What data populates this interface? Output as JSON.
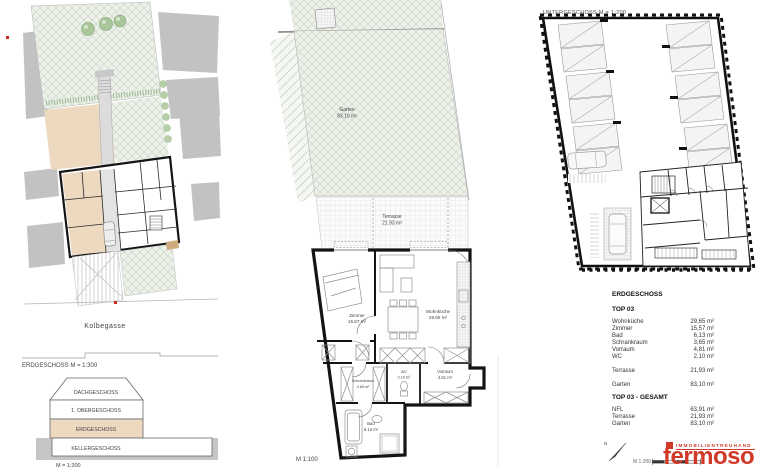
{
  "palette": {
    "logo_red": "#d13828",
    "highlight_beige": "#ecd9c0",
    "garden_green": "#edf1ea"
  },
  "site_plan": {
    "street_label": "Kolbegasse",
    "caption": "ERDGESCHOSS M = 1:300",
    "section": {
      "levels": [
        {
          "label": "DACHGESCHOSS"
        },
        {
          "label": "1. OBERGESCHOSS"
        },
        {
          "label": "ERDGESCHOSS"
        },
        {
          "label": "KELLERGESCHOSS"
        }
      ],
      "highlighted_level": "ERDGESCHOSS",
      "caption": "M = 1:300"
    }
  },
  "apartment_plan": {
    "caption": "M 1:100",
    "rooms": {
      "garten": {
        "name": "Garten",
        "area": "83.10 m²"
      },
      "terrasse": {
        "name": "Terrasse",
        "area": "21.93 m²"
      },
      "zimmer": {
        "name": "Zimmer",
        "area": "15.57 m²"
      },
      "wohnkueche": {
        "name": "Wohnküche",
        "area": "29.65 m²"
      },
      "schrankraum": {
        "name": "Schrankraum",
        "area": "3.65 m²"
      },
      "wc": {
        "name": "WC",
        "area": "2.10 m²"
      },
      "vorraum": {
        "name": "Vorraum",
        "area": "4.81 m²"
      },
      "bad": {
        "name": "Bad",
        "area": "6.13 m²"
      }
    }
  },
  "basement_plan": {
    "caption": "UNTERGESCHOSS    M = 1:200"
  },
  "summary": {
    "floor_heading": "ERDGESCHOSS",
    "unit_heading": "TOP 03",
    "rows": [
      {
        "label": "Wohnküche",
        "value": "29,65 m²"
      },
      {
        "label": "Zimmer",
        "value": "15,57 m²"
      },
      {
        "label": "Bad",
        "value": "6,13 m²"
      },
      {
        "label": "Schrankraum",
        "value": "3,65 m²"
      },
      {
        "label": "Vorraum",
        "value": "4,81 m²"
      },
      {
        "label": "WC",
        "value": "2,10 m²"
      }
    ],
    "terrace_row": {
      "label": "Terrasse",
      "value": "21,93 m²"
    },
    "garden_row": {
      "label": "Garten",
      "value": "83,10 m²"
    },
    "total_heading": "TOP 03 - GESAMT",
    "total_rows": [
      {
        "label": "NFL",
        "value": "63,91 m²"
      },
      {
        "label": "Terrasse",
        "value": "21,93 m²"
      },
      {
        "label": "Garten",
        "value": "83,10 m²"
      }
    ]
  },
  "footer": {
    "scale_label": "M 1:200",
    "north_label": "N"
  },
  "logo": {
    "tagline": "IMMOBILIENTREUHAND",
    "brand": "fermoso",
    "color": "#d13828"
  }
}
